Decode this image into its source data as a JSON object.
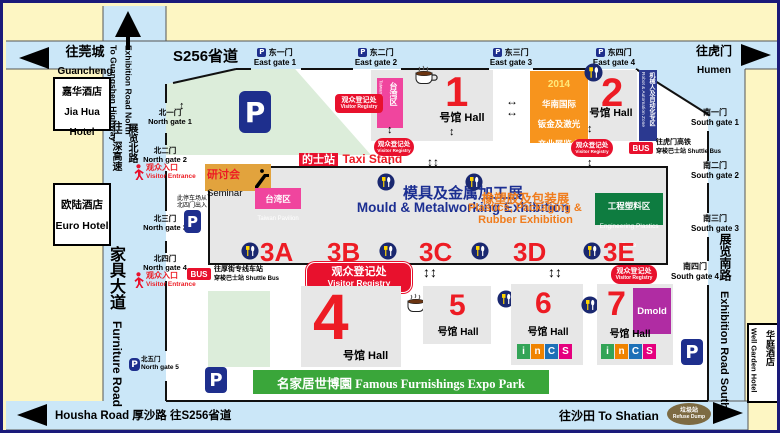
{
  "icons": {
    "parking": "P",
    "bus": "BUS",
    "v_arrow": "↕",
    "v_arrow2": "↕↕",
    "h_arrow": "↔"
  },
  "colors": {
    "red": "#e8112d",
    "navy": "#1e2f8d",
    "road_blue": "#cbe7f8",
    "orange_box": "#f7941d",
    "pink": "#f0459e",
    "green_zone": "#0e7c40",
    "banner_green": "#3aa63a",
    "purple": "#b02ca3",
    "parking_green": "#dcedda",
    "hall_grey": "#e7e7e7",
    "seminar_tan": "#e2a33d"
  },
  "roads": {
    "s256": "S256省道",
    "guancheng_zh": "往莞城",
    "guancheng_en": "Guancheng",
    "humen_zh": "往虎门",
    "humen_en": "Humen",
    "exh_north_en": "Exhibition Road North",
    "guangshen_en": "To Guangshen Highway",
    "exh_north_zh": "展览北路",
    "guangshen_zh": "往广深高速",
    "furniture_zh": "家具大道",
    "furniture_en": "Furniture Road",
    "exh_south_zh": "展览南路",
    "exh_south_en": "Exhibition Road South",
    "housha": "Housha Road  厚沙路   往S256省道",
    "shatian": "往沙田 To Shatian",
    "refuse_zh": "垃圾站",
    "refuse_en": "Refuse Dump"
  },
  "hotels": {
    "jiahua": {
      "zh": "嘉华酒店",
      "en1": "Jia Hua",
      "en2": "Hotel"
    },
    "euro": {
      "zh": "欧陆酒店",
      "en": "Euro Hotel"
    },
    "wellgarden": {
      "zh": "华庭酒店",
      "en": "Well Garden Hotel"
    }
  },
  "gates": {
    "north": [
      {
        "zh": "北一门",
        "en": "North gate 1"
      },
      {
        "zh": "北二门",
        "en": "North gate 2"
      },
      {
        "zh": "北三门",
        "en": "North gate 3"
      },
      {
        "zh": "北四门",
        "en": "North gate 4"
      },
      {
        "zh": "北五门",
        "en": "North gate 5"
      }
    ],
    "east": [
      {
        "zh": "东一门",
        "en": "East gate 1"
      },
      {
        "zh": "东二门",
        "en": "East gate 2"
      },
      {
        "zh": "东三门",
        "en": "East gate 3"
      },
      {
        "zh": "东四门",
        "en": "East gate 4"
      }
    ],
    "south": [
      {
        "zh": "南一门",
        "en": "South gate 1"
      },
      {
        "zh": "南二门",
        "en": "South gate 2"
      },
      {
        "zh": "南三门",
        "en": "South gate 3"
      },
      {
        "zh": "南四门",
        "en": "South gate 4"
      }
    ]
  },
  "labels": {
    "visitor_entrance_zh": "观众入口",
    "visitor_entrance_en": "Visitor Entrance",
    "visitor_registry_zh": "观众登记处",
    "visitor_registry_en": "Visitor Registry",
    "parking_note1": "此停车场从",
    "parking_note2": "北四门出入",
    "taxi_zh": "的士站",
    "taxi_en": "Taxi Stand",
    "seminar_zh": "研讨会",
    "seminar_en": "Seminar"
  },
  "bus": {
    "left1": "往厚街专线车站",
    "left2": "穿梭巴士站 Shuttle Bus",
    "right1": "往虎门高铁",
    "right2": "穿梭巴士站 Shuttle Bus"
  },
  "show2014": {
    "year": "2014",
    "zh1": "华南国际",
    "zh2": "钣金及激光",
    "zh3": "产业展览会",
    "en1": "Sheet Metal &",
    "en2": "Laser Show"
  },
  "zones": {
    "taiwan_zh": "台湾区",
    "taiwan_en": "Taiwan Pavilion",
    "robot_zh": "机械人及自动化专区",
    "robot_en": "Robot & Automation Zone",
    "mould_zh": "模具及金属加工展",
    "mould_en": "Mould & Metalworking Exhibition",
    "plastics_zh": "橡塑胶及包装展",
    "plastics_en1": "Plastics, Packaging &",
    "plastics_en2": "Rubber Exhibition",
    "eng_zh": "工程塑料区",
    "eng_en1": "Engineering Plastics",
    "eng_en2": "Zone",
    "dmold": "Dmold",
    "expo": "名家居世博園 Famous Furnishings Expo Park"
  },
  "halls": {
    "h1": "1",
    "h2": "2",
    "h4": "4",
    "h5": "5",
    "h6": "6",
    "h7": "7",
    "suffix": "号馆 Hall",
    "sections": [
      "3A",
      "3B",
      "3C",
      "3D",
      "3E"
    ]
  },
  "logo": {
    "letters": [
      "i",
      "n",
      "C",
      "S"
    ]
  }
}
